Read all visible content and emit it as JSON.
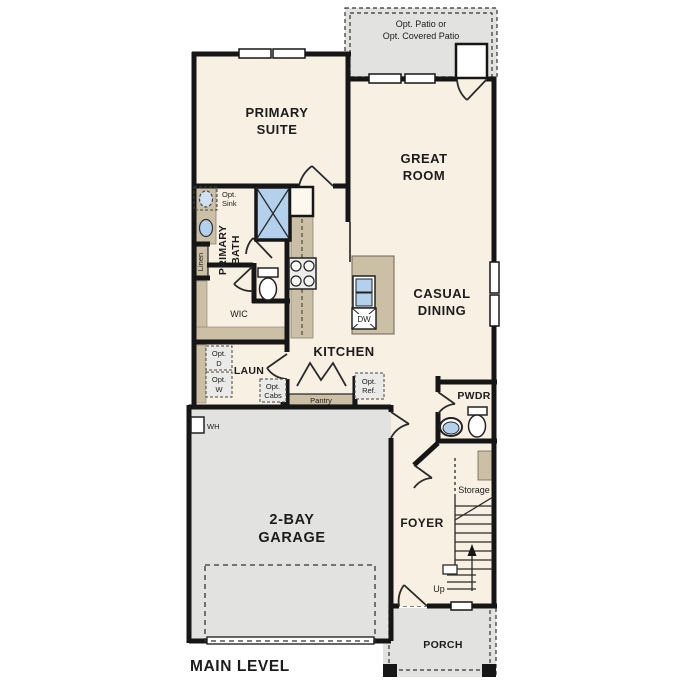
{
  "plan": {
    "title": "MAIN LEVEL",
    "rooms": {
      "patio": {
        "line1": "Opt. Patio or",
        "line2": "Opt. Covered Patio"
      },
      "primary_suite": {
        "line1": "PRIMARY",
        "line2": "SUITE"
      },
      "great_room": {
        "line1": "GREAT",
        "line2": "ROOM"
      },
      "primary_bath": {
        "line1": "PRIMARY",
        "line2": "BATH"
      },
      "casual_dining": {
        "line1": "CASUAL",
        "line2": "DINING"
      },
      "kitchen": {
        "label": "KITCHEN"
      },
      "wic": {
        "label": "WIC"
      },
      "laundry": {
        "label": "LAUN"
      },
      "powder": {
        "label": "PWDR"
      },
      "foyer": {
        "label": "FOYER"
      },
      "garage": {
        "line1": "2-BAY",
        "line2": "GARAGE"
      },
      "porch": {
        "label": "PORCH"
      },
      "storage": {
        "label": "Storage"
      },
      "pantry": {
        "label": "Pantry"
      },
      "linen": {
        "label": "Linen"
      }
    },
    "fixtures": {
      "dishwasher": "DW",
      "water_heater": "WH",
      "stairs_up": "Up"
    },
    "options": {
      "sink": {
        "line1": "Opt.",
        "line2": "Sink"
      },
      "dryer": {
        "line1": "Opt.",
        "line2": "D"
      },
      "washer": {
        "line1": "Opt.",
        "line2": "W"
      },
      "cabinets": {
        "line1": "Opt.",
        "line2": "Cabs"
      },
      "refrigerator": {
        "line1": "Opt.",
        "line2": "Ref."
      }
    },
    "colors": {
      "floor": "#f8f0e2",
      "outdoor": "#e2e2e1",
      "cabinet": "#cbbfa5",
      "water": "#b3d0ec",
      "wall": "#161616"
    }
  }
}
